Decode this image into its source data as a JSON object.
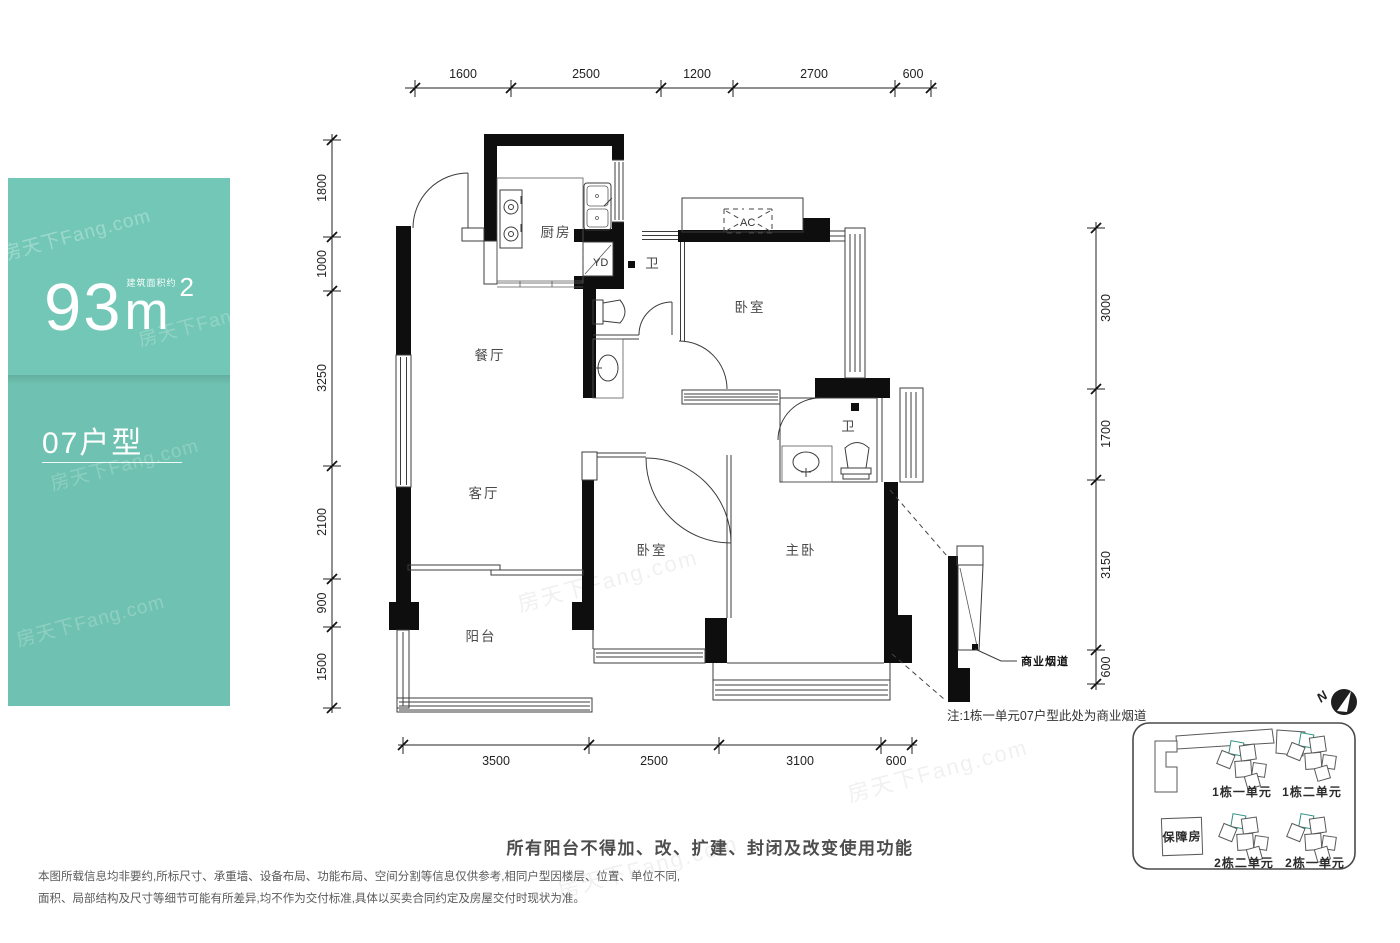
{
  "panel": {
    "area_prefix_label": "建筑面积约",
    "area_value": "93",
    "area_unit": "m",
    "area_exponent": "2",
    "unit_type": "07户型"
  },
  "plan": {
    "rooms": {
      "kitchen": "厨房",
      "dining": "餐厅",
      "living": "客厅",
      "balcony": "阳台",
      "bedroom_top": "卧室",
      "bedroom_mid": "卧室",
      "master": "主卧",
      "bath_top": "卫",
      "bath_master": "卫",
      "flue_shaft": "YD",
      "ac": "AC"
    },
    "dims": {
      "top": [
        "1600",
        "2500",
        "1200",
        "2700",
        "600"
      ],
      "left": [
        "1800",
        "1000",
        "3250",
        "2100",
        "900",
        "1500"
      ],
      "right": [
        "3000",
        "1700",
        "3150",
        "600"
      ],
      "bottom": [
        "3500",
        "2500",
        "3100",
        "600"
      ]
    },
    "flue_label": "商业烟道",
    "note": "注:1栋一单元07户型此处为商业烟道"
  },
  "siteplan": {
    "north": "N",
    "buildings": [
      "1栋一单元",
      "1栋二单元",
      "2栋二单元",
      "2栋一单元"
    ],
    "support_housing": "保障房"
  },
  "footer": {
    "balcony_notice": "所有阳台不得加、改、扩建、封闭及改变使用功能",
    "disclaimer_line1": "本图所载信息均非要约,所标尺寸、承重墙、设备布局、功能布局、空间分割等信息仅供参考,相同户型因楼层、位置、单位不同,",
    "disclaimer_line2": "面积、局部结构及尺寸等细节可能有所差异,均不作为交付标准,具体以买卖合同约定及房屋交付时现状为准。"
  },
  "watermark": {
    "text": "房天下Fang.com"
  },
  "colors": {
    "panel_teal": "#73c7b6",
    "panel_teal_dark": "#6fc2b1",
    "site_unit_teal": "#3fa89b",
    "wall_black": "#0e0e0e"
  }
}
